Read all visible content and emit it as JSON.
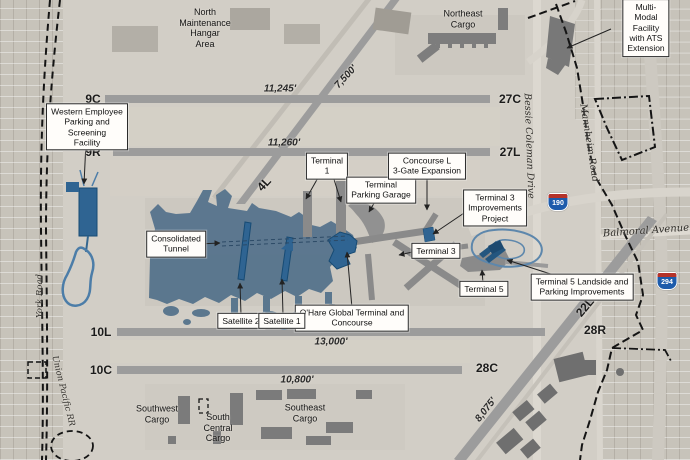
{
  "map": {
    "boxed_labels": {
      "western_employee": "Western Employee\nParking and Screening\nFacility",
      "consolidated_tunnel": "Consolidated\nTunnel",
      "terminal_1": "Terminal\n1",
      "terminal_parking_garage": "Terminal\nParking Garage",
      "concourse_l": "Concourse L\n3-Gate Expansion",
      "terminal_3_improvements": "Terminal 3\nImprovements\nProject",
      "terminal_3": "Terminal 3",
      "terminal_5": "Terminal 5",
      "terminal_5_landside": "Terminal 5 Landside and\nParking Improvements",
      "ohare_global": "O'Hare Global Terminal and\nConcourse",
      "satellite_2": "Satellite 2",
      "satellite_1": "Satellite 1",
      "multi_modal": "Multi-Modal Facility\nwith ATS Extension"
    },
    "area_labels": {
      "north_maintenance": "North\nMaintenance\nHangar\nArea",
      "northeast_cargo": "Northeast\nCargo",
      "southwest_cargo": "Southwest\nCargo",
      "south_central_cargo": "South\nCentral\nCargo",
      "southeast_cargo": "Southeast\nCargo"
    },
    "runways": {
      "r9c": "9C",
      "r27c": "27C",
      "r9r": "9R",
      "r27l": "27L",
      "r10l": "10L",
      "r28r": "28R",
      "r10c": "10C",
      "r28c": "28C",
      "r4l": "4L",
      "r22l": "22L",
      "len_9c": "11,245'",
      "len_9r": "11,260'",
      "len_4l": "7,500'",
      "len_10l": "13,000'",
      "len_10c": "10,800'",
      "len_22l": "8,075'"
    },
    "roads": {
      "york": "York Road",
      "union_pacific": "Union Pacific RR",
      "bessie_coleman": "Bessie Coleman Drive",
      "mannheim": "Mannheim Road",
      "balmoral": "Balmoral Avenue"
    },
    "highways": {
      "i190": "190",
      "i294": "294"
    },
    "colors": {
      "new_construction": "#2f6492",
      "apron_overlay": "#55738c",
      "existing_terminal": "#8a8a8a",
      "runway": "#9c9c9c"
    }
  }
}
